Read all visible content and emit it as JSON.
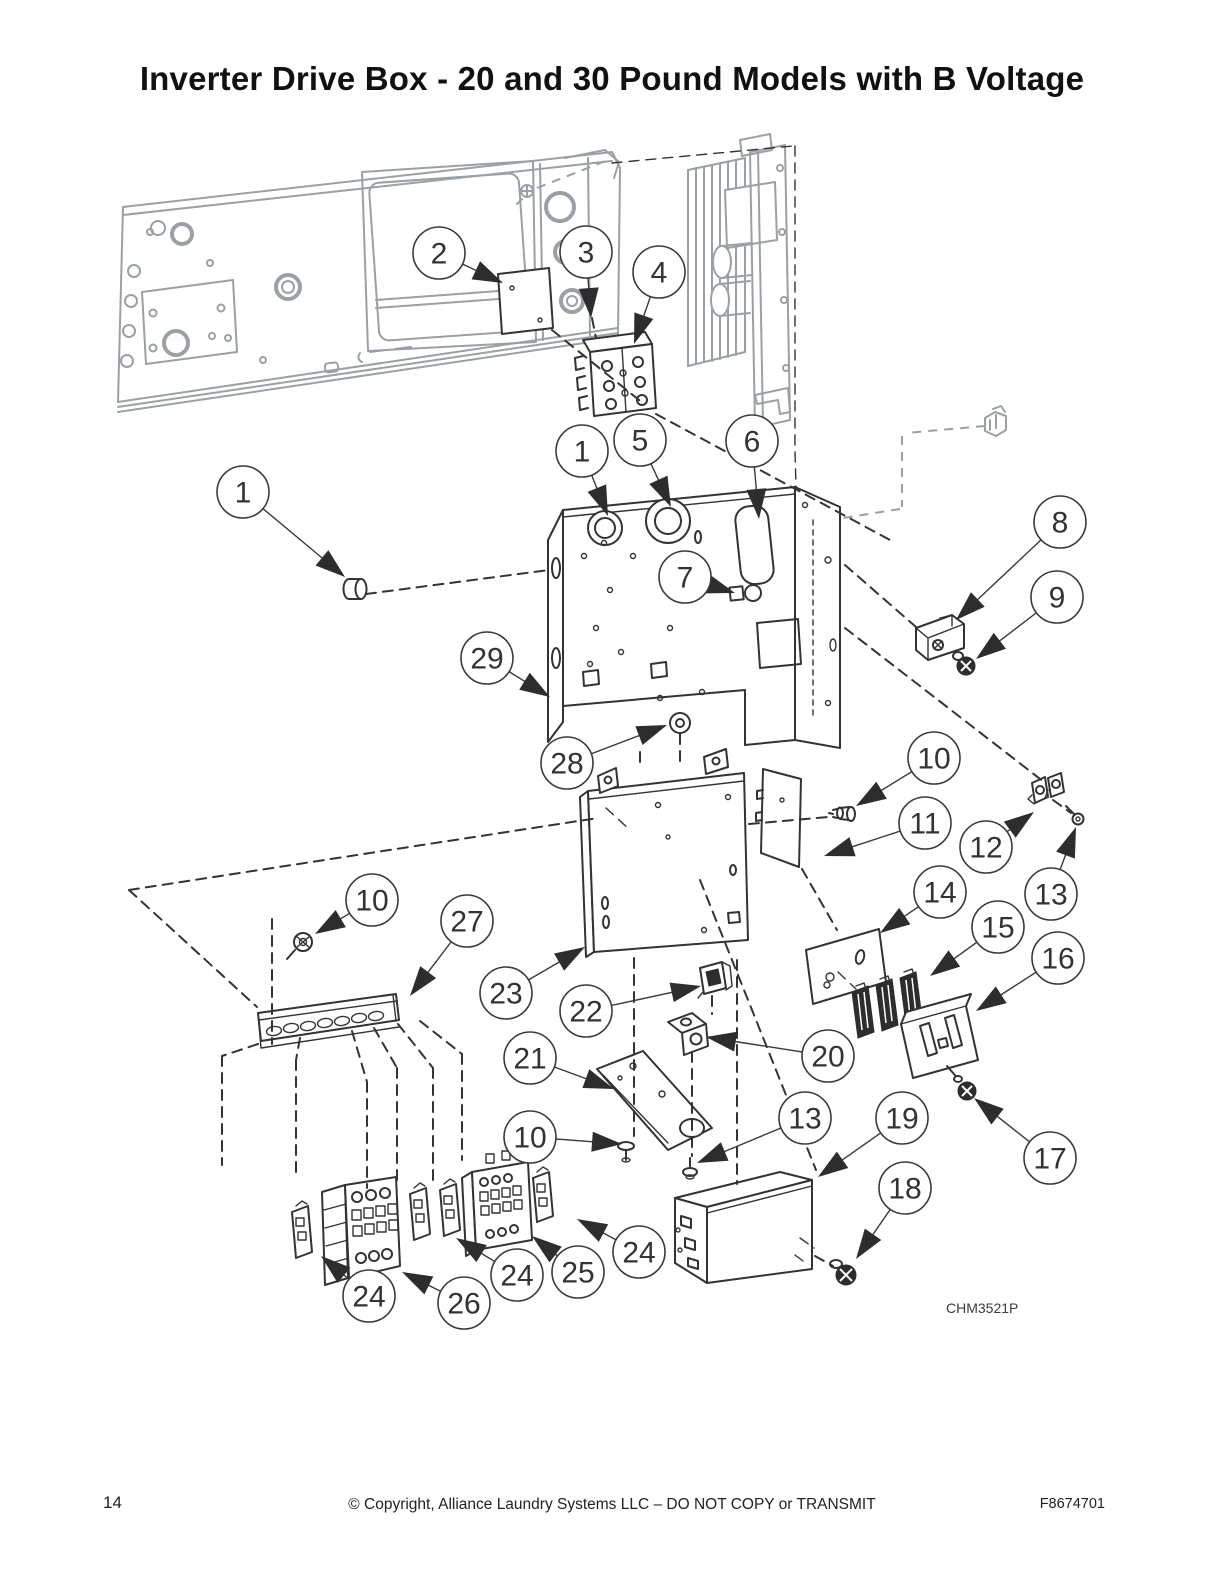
{
  "page": {
    "title": "Inverter Drive Box - 20 and 30 Pound Models with B Voltage",
    "figure_label": "CHM3521P",
    "footer": {
      "page_number": "14",
      "copyright": "© Copyright, Alliance Laundry Systems LLC – DO NOT COPY or TRANSMIT",
      "document_number": "F8674701"
    }
  },
  "colors": {
    "line": "#333333",
    "secondary_gray": "#9aa0a5",
    "background": "#ffffff"
  },
  "diagram": {
    "type": "exploded-parts-diagram",
    "item_numbers_present": [
      "1",
      "2",
      "3",
      "4",
      "5",
      "6",
      "7",
      "8",
      "9",
      "10",
      "11",
      "12",
      "13",
      "14",
      "15",
      "16",
      "17",
      "18",
      "19",
      "20",
      "21",
      "22",
      "23",
      "24",
      "25",
      "26",
      "27",
      "28",
      "29"
    ],
    "callouts": [
      {
        "label": "2",
        "cx": 439,
        "cy": 253,
        "tx": 503,
        "ty": 283
      },
      {
        "label": "3",
        "cx": 586,
        "cy": 252,
        "tx": 591,
        "ty": 318
      },
      {
        "label": "4",
        "cx": 659,
        "cy": 272,
        "tx": 634,
        "ty": 344
      },
      {
        "label": "1",
        "cx": 243,
        "cy": 492,
        "tx": 345,
        "ty": 577
      },
      {
        "label": "1",
        "cx": 582,
        "cy": 451,
        "tx": 608,
        "ty": 516
      },
      {
        "label": "5",
        "cx": 640,
        "cy": 440,
        "tx": 671,
        "ty": 507
      },
      {
        "label": "6",
        "cx": 752,
        "cy": 441,
        "tx": 759,
        "ty": 519
      },
      {
        "label": "7",
        "cx": 685,
        "cy": 577,
        "tx": 735,
        "ty": 593
      },
      {
        "label": "8",
        "cx": 1060,
        "cy": 522,
        "tx": 956,
        "ty": 620
      },
      {
        "label": "9",
        "cx": 1057,
        "cy": 597,
        "tx": 976,
        "ty": 659
      },
      {
        "label": "29",
        "cx": 487,
        "cy": 658,
        "tx": 550,
        "ty": 697
      },
      {
        "label": "28",
        "cx": 567,
        "cy": 763,
        "tx": 667,
        "ty": 725
      },
      {
        "label": "10",
        "cx": 934,
        "cy": 758,
        "tx": 856,
        "ty": 806
      },
      {
        "label": "11",
        "cx": 925,
        "cy": 823,
        "tx": 824,
        "ty": 856
      },
      {
        "label": "12",
        "cx": 986,
        "cy": 847,
        "tx": 1034,
        "ty": 812
      },
      {
        "label": "13",
        "cx": 1051,
        "cy": 894,
        "tx": 1076,
        "ty": 827
      },
      {
        "label": "14",
        "cx": 940,
        "cy": 892,
        "tx": 880,
        "ty": 933
      },
      {
        "label": "15",
        "cx": 998,
        "cy": 927,
        "tx": 930,
        "ty": 976
      },
      {
        "label": "16",
        "cx": 1058,
        "cy": 958,
        "tx": 976,
        "ty": 1011
      },
      {
        "label": "17",
        "cx": 1050,
        "cy": 1158,
        "tx": 974,
        "ty": 1098
      },
      {
        "label": "10",
        "cx": 372,
        "cy": 900,
        "tx": 315,
        "ty": 934
      },
      {
        "label": "27",
        "cx": 467,
        "cy": 921,
        "tx": 410,
        "ty": 996
      },
      {
        "label": "23",
        "cx": 506,
        "cy": 993,
        "tx": 585,
        "ty": 947
      },
      {
        "label": "22",
        "cx": 586,
        "cy": 1011,
        "tx": 701,
        "ty": 986
      },
      {
        "label": "21",
        "cx": 530,
        "cy": 1058,
        "tx": 614,
        "ty": 1089
      },
      {
        "label": "20",
        "cx": 828,
        "cy": 1056,
        "tx": 706,
        "ty": 1037
      },
      {
        "label": "10",
        "cx": 530,
        "cy": 1137,
        "tx": 622,
        "ty": 1144
      },
      {
        "label": "13",
        "cx": 805,
        "cy": 1118,
        "tx": 697,
        "ty": 1163
      },
      {
        "label": "19",
        "cx": 902,
        "cy": 1118,
        "tx": 818,
        "ty": 1177
      },
      {
        "label": "18",
        "cx": 905,
        "cy": 1188,
        "tx": 856,
        "ty": 1259
      },
      {
        "label": "24",
        "cx": 369,
        "cy": 1296,
        "tx": 321,
        "ty": 1256
      },
      {
        "label": "26",
        "cx": 464,
        "cy": 1303,
        "tx": 402,
        "ty": 1272
      },
      {
        "label": "24",
        "cx": 517,
        "cy": 1275,
        "tx": 456,
        "ty": 1238
      },
      {
        "label": "25",
        "cx": 578,
        "cy": 1272,
        "tx": 532,
        "ty": 1236
      },
      {
        "label": "24",
        "cx": 639,
        "cy": 1252,
        "tx": 577,
        "ty": 1219
      }
    ]
  }
}
